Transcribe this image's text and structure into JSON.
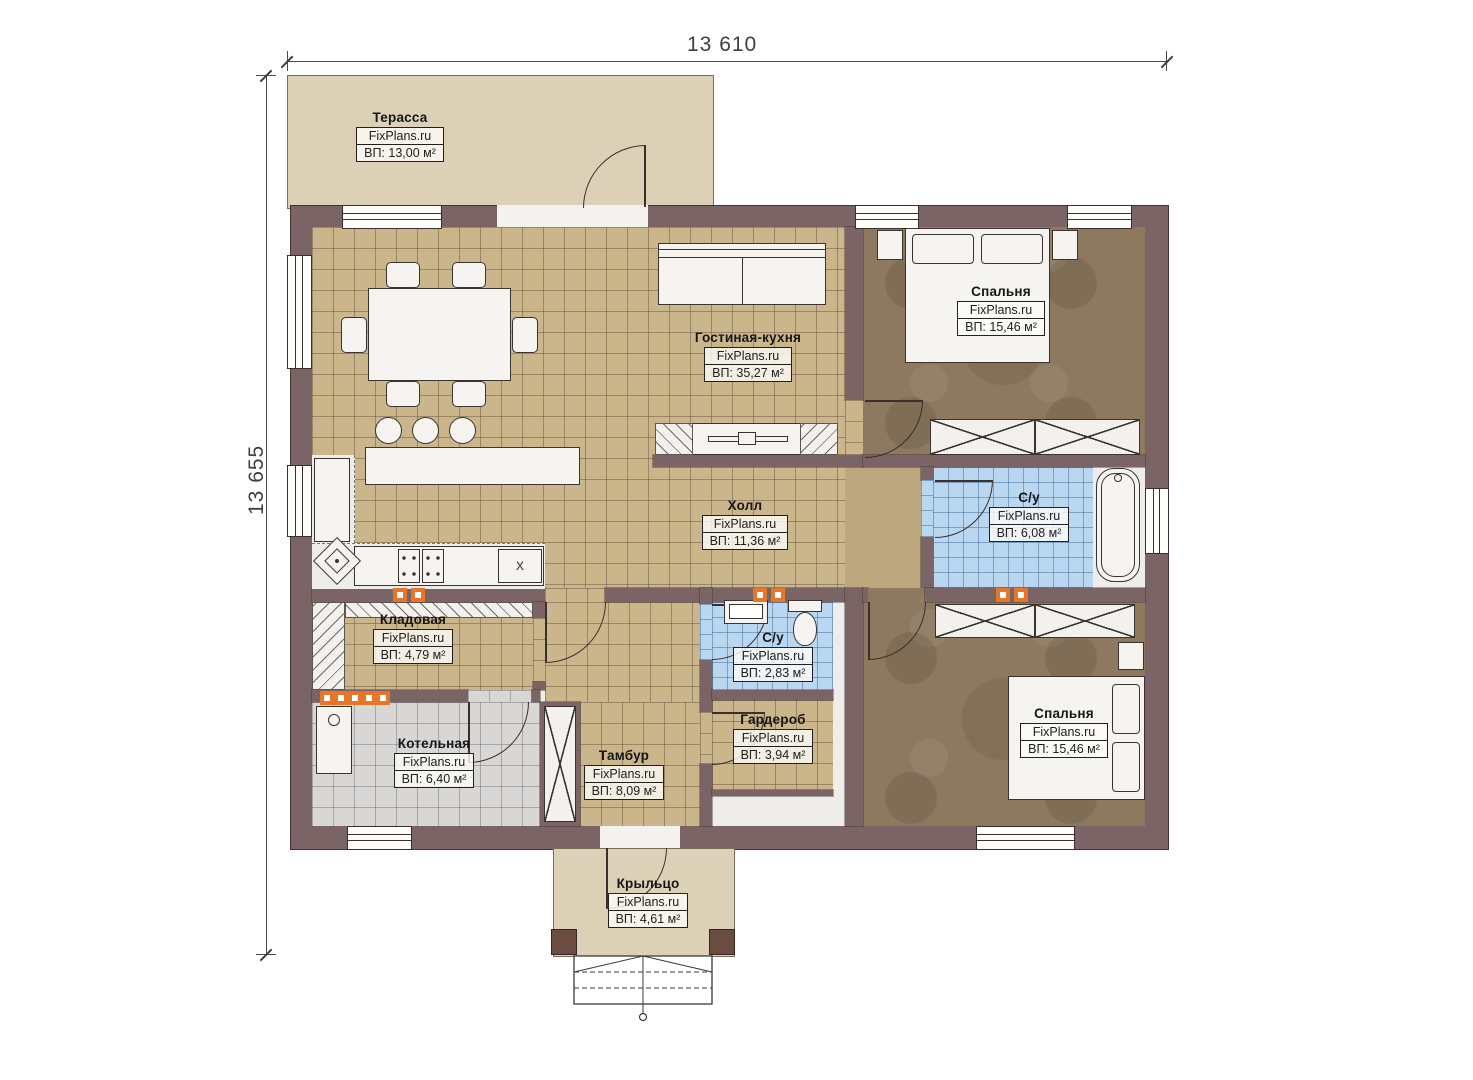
{
  "brand": "FixPlans.ru",
  "dimensions": {
    "width_label": "13 610",
    "height_label": "13 655"
  },
  "rooms": {
    "terrace": {
      "name": "Терасса",
      "area": "ВП: 13,00 м²"
    },
    "living": {
      "name": "Гостиная-кухня",
      "area": "ВП: 35,27 м²"
    },
    "bedroom_top": {
      "name": "Спальня",
      "area": "ВП: 15,46 м²"
    },
    "hall": {
      "name": "Холл",
      "area": "ВП: 11,36 м²"
    },
    "bathroom_main": {
      "name": "С/у",
      "area": "ВП: 6,08 м²"
    },
    "pantry": {
      "name": "Кладовая",
      "area": "ВП: 4,79 м²"
    },
    "bathroom_small": {
      "name": "С/у",
      "area": "ВП: 2,83 м²"
    },
    "boiler": {
      "name": "Котельная",
      "area": "ВП: 6,40 м²"
    },
    "tambour": {
      "name": "Тамбур",
      "area": "ВП: 8,09 м²"
    },
    "wardrobe": {
      "name": "Гардероб",
      "area": "ВП: 3,94 м²"
    },
    "bedroom_bottom": {
      "name": "Спальня",
      "area": "ВП: 15,46 м²"
    },
    "porch": {
      "name": "Крыльцо",
      "area": "ВП: 4,61 м²"
    }
  },
  "plan_marks": {
    "appliance_x": "x"
  },
  "colors": {
    "wall": "#7a6466",
    "tile_beige": "#cbb68c",
    "tile_blue": "#bad7f1",
    "tile_grey": "#d8d7d5",
    "floor_brown": "#8d7960",
    "terrace": "#dcd1b6",
    "accent_orange": "#e8762a"
  }
}
